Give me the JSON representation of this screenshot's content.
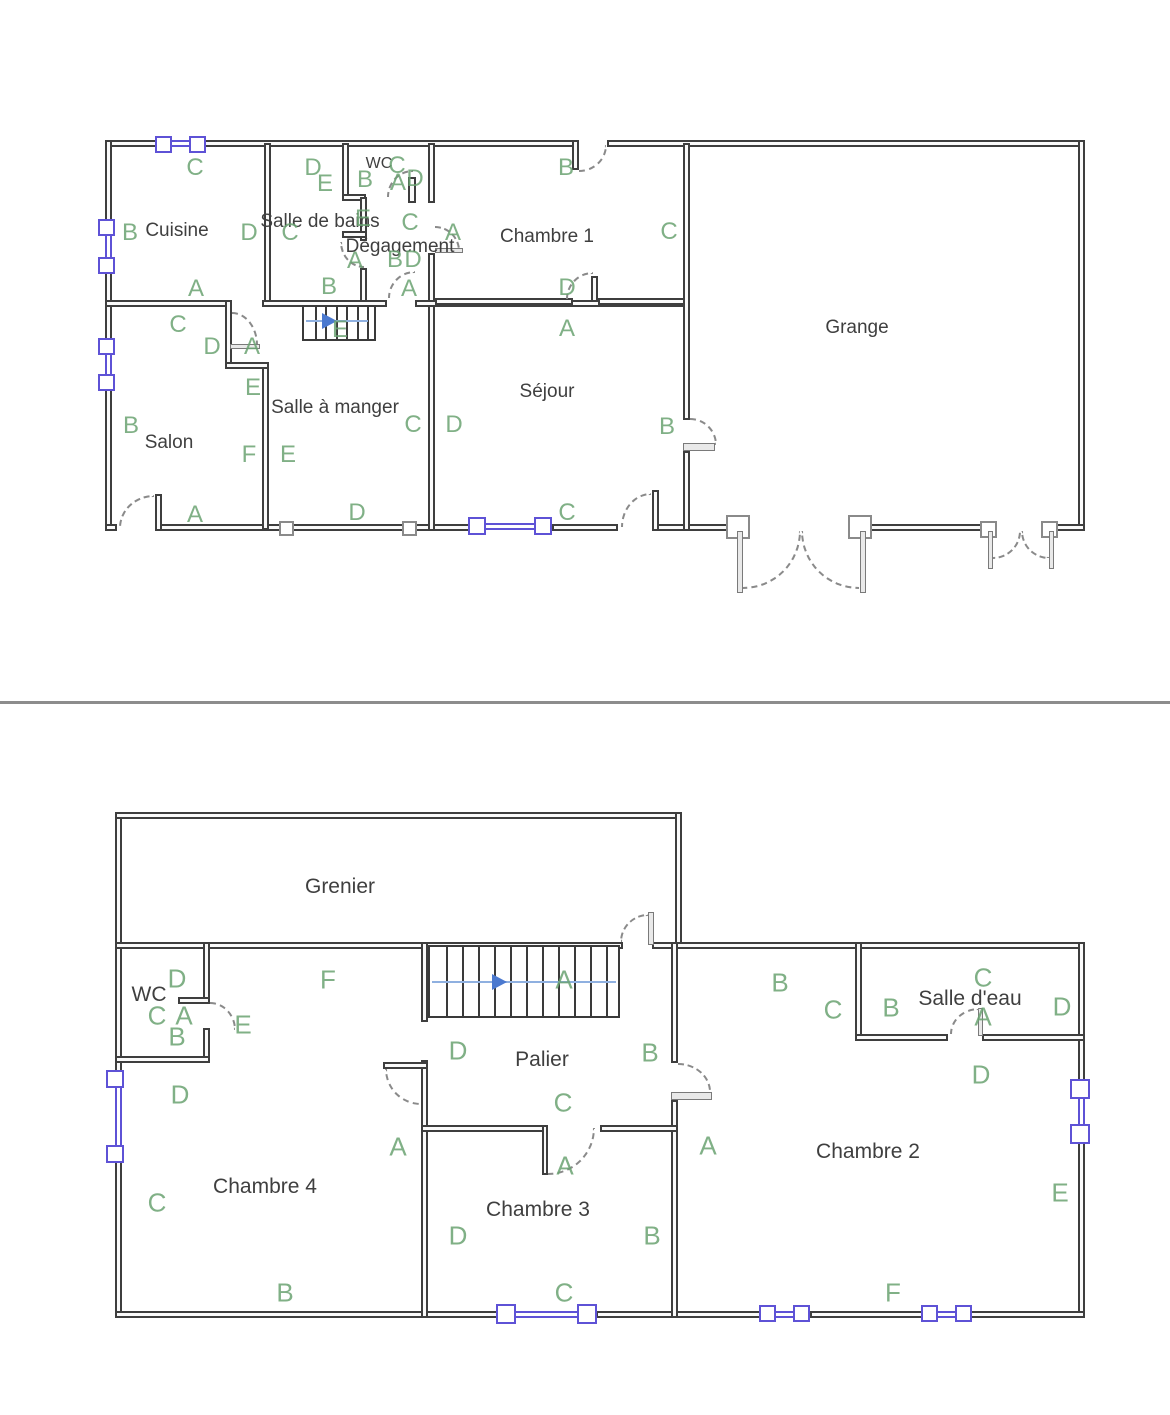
{
  "document": {
    "title": "Plans de la maison",
    "divider": ""
  },
  "colors": {
    "wall": "#3e3e3e",
    "letter_green": "#6aa371",
    "room_text": "#3f3f3f",
    "window_purple": "#5e52d6",
    "arrow_blue": "#4b79cf",
    "divider_gray": "#8c8c8c"
  },
  "floor1": {
    "rooms": [
      {
        "name": "Cuisine",
        "x": 177,
        "y": 231
      },
      {
        "name": "Salle de bains",
        "x": 320,
        "y": 222
      },
      {
        "name": "WC",
        "x": 379,
        "y": 164,
        "small": true
      },
      {
        "name": "Dégagement",
        "x": 400,
        "y": 247
      },
      {
        "name": "Chambre 1",
        "x": 547,
        "y": 237
      },
      {
        "name": "Grange",
        "x": 857,
        "y": 328
      },
      {
        "name": "Salon",
        "x": 169,
        "y": 443
      },
      {
        "name": "Salle à manger",
        "x": 335,
        "y": 408
      },
      {
        "name": "Séjour",
        "x": 547,
        "y": 392
      }
    ],
    "letters": [
      {
        "t": "C",
        "x": 195,
        "y": 168
      },
      {
        "t": "B",
        "x": 130,
        "y": 233
      },
      {
        "t": "D",
        "x": 249,
        "y": 233
      },
      {
        "t": "A",
        "x": 196,
        "y": 289
      },
      {
        "t": "C",
        "x": 178,
        "y": 325
      },
      {
        "t": "D",
        "x": 212,
        "y": 347
      },
      {
        "t": "A",
        "x": 252,
        "y": 347
      },
      {
        "t": "E",
        "x": 253,
        "y": 388
      },
      {
        "t": "B",
        "x": 131,
        "y": 426
      },
      {
        "t": "F",
        "x": 249,
        "y": 455
      },
      {
        "t": "E",
        "x": 288,
        "y": 455
      },
      {
        "t": "A",
        "x": 195,
        "y": 515
      },
      {
        "t": "D",
        "x": 357,
        "y": 513
      },
      {
        "t": "D",
        "x": 313,
        "y": 168
      },
      {
        "t": "E",
        "x": 325,
        "y": 184
      },
      {
        "t": "C",
        "x": 290,
        "y": 233
      },
      {
        "t": "E",
        "x": 363,
        "y": 219
      },
      {
        "t": "B",
        "x": 365,
        "y": 180
      },
      {
        "t": "C",
        "x": 397,
        "y": 166
      },
      {
        "t": "A",
        "x": 398,
        "y": 183
      },
      {
        "t": "D",
        "x": 415,
        "y": 179
      },
      {
        "t": "C",
        "x": 410,
        "y": 223
      },
      {
        "t": "A",
        "x": 453,
        "y": 233
      },
      {
        "t": "B",
        "x": 395,
        "y": 260
      },
      {
        "t": "D",
        "x": 413,
        "y": 260
      },
      {
        "t": "A",
        "x": 355,
        "y": 261
      },
      {
        "t": "A",
        "x": 409,
        "y": 289
      },
      {
        "t": "B",
        "x": 329,
        "y": 287
      },
      {
        "t": "E",
        "x": 340,
        "y": 330
      },
      {
        "t": "C",
        "x": 413,
        "y": 425
      },
      {
        "t": "D",
        "x": 454,
        "y": 425
      },
      {
        "t": "B",
        "x": 566,
        "y": 168
      },
      {
        "t": "C",
        "x": 669,
        "y": 232
      },
      {
        "t": "D",
        "x": 567,
        "y": 288
      },
      {
        "t": "A",
        "x": 567,
        "y": 329
      },
      {
        "t": "B",
        "x": 667,
        "y": 427
      },
      {
        "t": "C",
        "x": 567,
        "y": 513
      }
    ]
  },
  "floor2": {
    "rooms": [
      {
        "name": "Grenier",
        "x": 340,
        "y": 887
      },
      {
        "name": "WC",
        "x": 149,
        "y": 995
      },
      {
        "name": "Palier",
        "x": 542,
        "y": 1060
      },
      {
        "name": "Salle d'eau",
        "x": 970,
        "y": 999
      },
      {
        "name": "Chambre 4",
        "x": 265,
        "y": 1187
      },
      {
        "name": "Chambre 3",
        "x": 538,
        "y": 1210
      },
      {
        "name": "Chambre 2",
        "x": 868,
        "y": 1152
      }
    ],
    "letters": [
      {
        "t": "D",
        "x": 177,
        "y": 979
      },
      {
        "t": "C",
        "x": 157,
        "y": 1016
      },
      {
        "t": "A",
        "x": 184,
        "y": 1016
      },
      {
        "t": "B",
        "x": 177,
        "y": 1037
      },
      {
        "t": "E",
        "x": 243,
        "y": 1025
      },
      {
        "t": "F",
        "x": 328,
        "y": 980
      },
      {
        "t": "D",
        "x": 180,
        "y": 1095
      },
      {
        "t": "C",
        "x": 157,
        "y": 1203
      },
      {
        "t": "B",
        "x": 285,
        "y": 1293
      },
      {
        "t": "A",
        "x": 398,
        "y": 1147
      },
      {
        "t": "A",
        "x": 564,
        "y": 980
      },
      {
        "t": "D",
        "x": 458,
        "y": 1051
      },
      {
        "t": "B",
        "x": 650,
        "y": 1053
      },
      {
        "t": "C",
        "x": 563,
        "y": 1103
      },
      {
        "t": "A",
        "x": 565,
        "y": 1166
      },
      {
        "t": "D",
        "x": 458,
        "y": 1236
      },
      {
        "t": "B",
        "x": 652,
        "y": 1236
      },
      {
        "t": "C",
        "x": 564,
        "y": 1293
      },
      {
        "t": "A",
        "x": 708,
        "y": 1146
      },
      {
        "t": "B",
        "x": 780,
        "y": 983
      },
      {
        "t": "C",
        "x": 833,
        "y": 1010
      },
      {
        "t": "B",
        "x": 891,
        "y": 1008
      },
      {
        "t": "C",
        "x": 983,
        "y": 978
      },
      {
        "t": "A",
        "x": 983,
        "y": 1017
      },
      {
        "t": "D",
        "x": 1062,
        "y": 1007
      },
      {
        "t": "D",
        "x": 981,
        "y": 1075
      },
      {
        "t": "E",
        "x": 1060,
        "y": 1193
      },
      {
        "t": "F",
        "x": 893,
        "y": 1293
      }
    ]
  }
}
